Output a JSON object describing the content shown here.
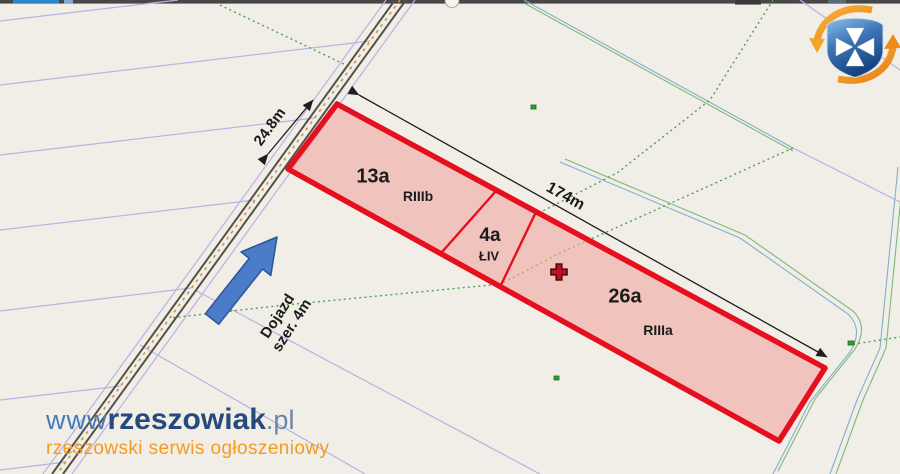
{
  "map": {
    "parcels": [
      {
        "area_label": "13a",
        "soil_label": "RIIIb"
      },
      {
        "area_label": "4a",
        "soil_label": "ŁIV"
      },
      {
        "area_label": "26a",
        "soil_label": "RIIIa"
      }
    ],
    "dimensions": {
      "frontage": "24.8m",
      "length": "174m"
    },
    "access_note": {
      "line1": "Dojazd",
      "line2": "szer. 4m"
    },
    "icons": {
      "logo": "rzeszow-crest-logo",
      "cross_marker": "cross-marker",
      "direction_arrow": "access-direction-arrow"
    },
    "colors": {
      "outline_red": "#e60f1e",
      "parcel_fill_pink": "#f0c4be",
      "arrow_blue": "#4a7cc9",
      "cadastral_lavender": "#b7b2e4",
      "ditch_blue": "#84aecd",
      "ditch_green": "#7cb97a",
      "dotted_green": "#4fa04f"
    }
  },
  "watermark": {
    "www": "www",
    "brand": "rzeszowiak",
    "tld": ".pl",
    "tagline": "rzeszowski serwis ogłoszeniowy",
    "orange": "#f59b1e",
    "navy": "#27497e"
  }
}
